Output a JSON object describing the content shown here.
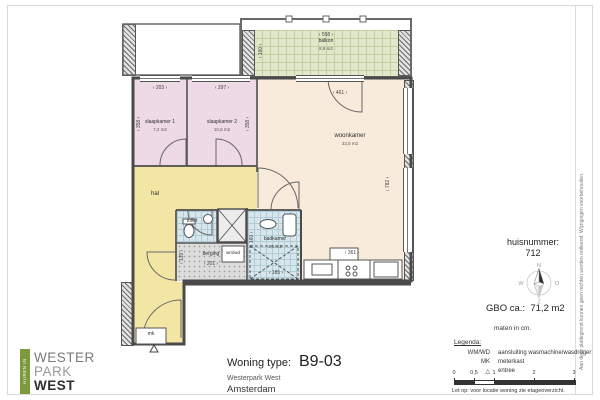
{
  "disclaimer": "Aan deze plattegrond kunnen geen rechten worden ontleend. Wijzigingen voorbehouden.",
  "logo": {
    "tagline": "HUREN IN",
    "line1": "WESTER",
    "line2": "PARK",
    "line3": "WEST"
  },
  "title_block": {
    "label": "Woning type:",
    "code": "B9-03",
    "project": "Westerpark West",
    "city": "Amsterdam"
  },
  "info": {
    "huisnummer_label": "huisnummer:",
    "huisnummer_value": "712",
    "gbo_label": "GBO ca.:",
    "gbo_value": "71,2 m2",
    "units_note": "maten in cm.",
    "legend_title": "Legenda:",
    "legend_items": [
      {
        "key": "WM/WD",
        "value": "aansluiting wasmachine/wasdroger"
      },
      {
        "key": "MK",
        "value": "meterkast"
      },
      {
        "key": "△",
        "value": "entree"
      }
    ],
    "scale_ticks": [
      "0",
      "0,5",
      "1",
      "2",
      "3"
    ],
    "attention_note": "Let op:  voor locatie woning zie etageoverzicht.",
    "compass": {
      "north": "N",
      "east": "O",
      "south": "Z",
      "west": "W"
    }
  },
  "rooms": {
    "balkon": {
      "name": "balkon",
      "area": "8,9 m2"
    },
    "slaapkamer1": {
      "name": "slaapkamer 1",
      "area": "7,2 m2"
    },
    "slaapkamer2": {
      "name": "slaapkamer 2",
      "area": "10,6 m2"
    },
    "woonkamer": {
      "name": "woonkamer",
      "area": "33,5 m2"
    },
    "hal": {
      "name": "hal"
    },
    "toilet": {
      "name": "toilet"
    },
    "badkamer": {
      "name": "badkamer",
      "area": "4,5 m2"
    },
    "berging": {
      "name": "berging"
    },
    "meterkast": "mk",
    "washer": "wm/wd"
  },
  "dims": {
    "balkon_w": "‹ 558 ›",
    "balkon_d": "‹ 160 ›",
    "sl1_w": "‹ 203 ›",
    "sl1_d": "‹ 358 ›",
    "sl2_w": "‹ 297 ›",
    "sl2_d": "‹ 358 ›",
    "woon_w": "‹ 461 ›",
    "woon_d": "‹ 782 ›",
    "kitchen_w": "‹ 361 ›",
    "berging_w": "‹ 201 ›",
    "berging_d": "‹ 139 ›",
    "badkamer_w": "‹ 185 ›",
    "badkamer_d": "‹ 160 ›"
  }
}
